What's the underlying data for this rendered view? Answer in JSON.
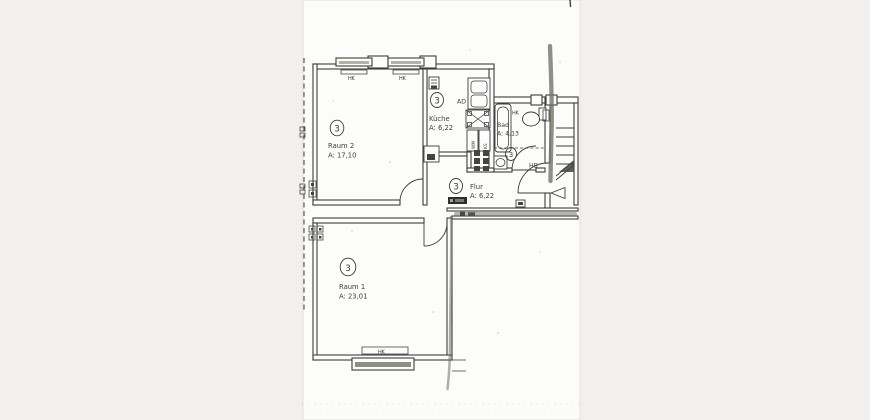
{
  "canvas": {
    "bg": "#f1f0ef",
    "paper": "#fcfcfa",
    "ink": "#3c3c3c",
    "marker": "#6f6e66"
  },
  "rooms": {
    "raum2": {
      "number": "3",
      "name": "Raum 2",
      "area": "A: 17,10"
    },
    "kueche": {
      "number": "3",
      "name": "Küche",
      "area": "A: 6,22"
    },
    "bad": {
      "number": "3",
      "name": "Bad",
      "area": "A: 4,13"
    },
    "flur": {
      "number": "3",
      "name": "Flur",
      "area": "A: 6,22"
    },
    "raum1": {
      "number": "3",
      "name": "Raum 1",
      "area": "A: 23,01"
    }
  },
  "labels": {
    "hk": "HK",
    "ad": "AD",
    "hb": "HB",
    "wm": "WM",
    "ks": "KS"
  }
}
